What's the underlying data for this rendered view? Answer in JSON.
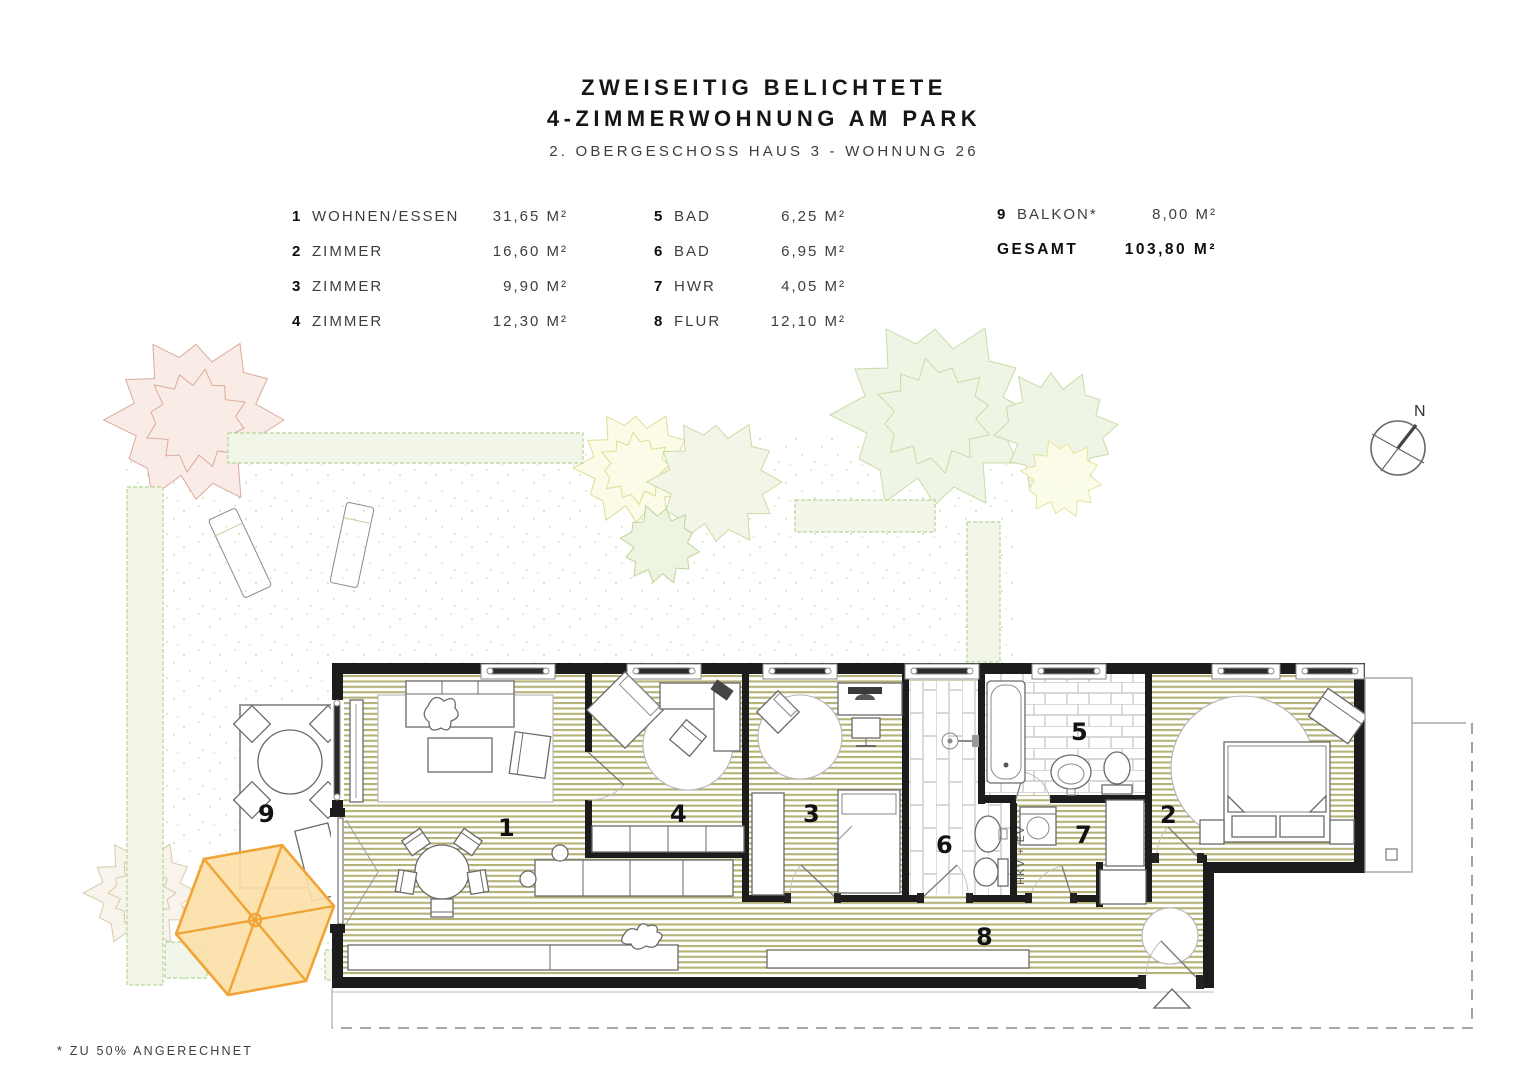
{
  "header": {
    "title_line1": "ZWEISEITIG BELICHTETE",
    "title_line2": "4-ZIMMERWOHNUNG AM PARK",
    "subtitle": "2. OBERGESCHOSS HAUS 3 - WOHNUNG 26"
  },
  "legend": {
    "columns": [
      {
        "rows": [
          {
            "num": "1",
            "name": "WOHNEN/ESSEN",
            "area": "31,65 M²"
          },
          {
            "num": "2",
            "name": "ZIMMER",
            "area": "16,60 M²"
          },
          {
            "num": "3",
            "name": "ZIMMER",
            "area": "9,90 M²"
          },
          {
            "num": "4",
            "name": "ZIMMER",
            "area": "12,30 M²"
          }
        ]
      },
      {
        "rows": [
          {
            "num": "5",
            "name": "BAD",
            "area": "6,25 M²"
          },
          {
            "num": "6",
            "name": "BAD",
            "area": "6,95 M²"
          },
          {
            "num": "7",
            "name": "HWR",
            "area": "4,05 M²"
          },
          {
            "num": "8",
            "name": "FLUR",
            "area": "12,10 M²"
          }
        ]
      },
      {
        "rows": [
          {
            "num": "9",
            "name": "BALKON*",
            "area": "8,00 M²"
          }
        ]
      }
    ],
    "total_label": "GESAMT",
    "total_area": "103,80 M²"
  },
  "footnote": "* ZU 50% ANGERECHNET",
  "plan": {
    "rooms": {
      "r1": "1",
      "r2": "2",
      "r3": "3",
      "r4": "4",
      "r5": "5",
      "r6": "6",
      "r7": "7",
      "r8": "8",
      "r9": "9"
    },
    "utility_label": "HKV + EV",
    "compass_label": "N"
  },
  "colors": {
    "floor_hatch": "#b5b277",
    "wall": "#1c1c1c",
    "umbrella_fill": "#fbdfa8",
    "umbrella_stroke": "#f0a336",
    "hedge_stroke": "#b9d49b",
    "tree_pink": "#dba695",
    "tree_green": "#c9d99e"
  }
}
